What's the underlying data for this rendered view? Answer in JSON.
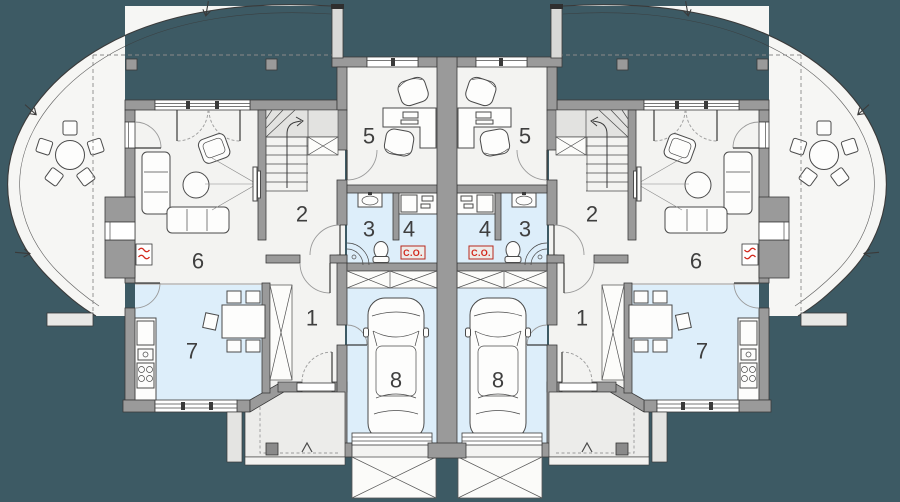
{
  "plan": {
    "rooms": {
      "r1": "1",
      "r2": "2",
      "r3": "3",
      "r4": "4",
      "r5": "5",
      "r6": "6",
      "r7": "7",
      "r8": "8"
    },
    "labels": {
      "central_heating": "C.O."
    },
    "colors": {
      "background": "#3d5a64",
      "wall": "#9a9a9a",
      "floor": "#f3f3f1",
      "terrace": "#f6f6f4",
      "wet_room_floor": "#ddeefa",
      "porch": "#ececea",
      "accent_red": "#d3281c",
      "line": "#3a3a3a"
    }
  }
}
